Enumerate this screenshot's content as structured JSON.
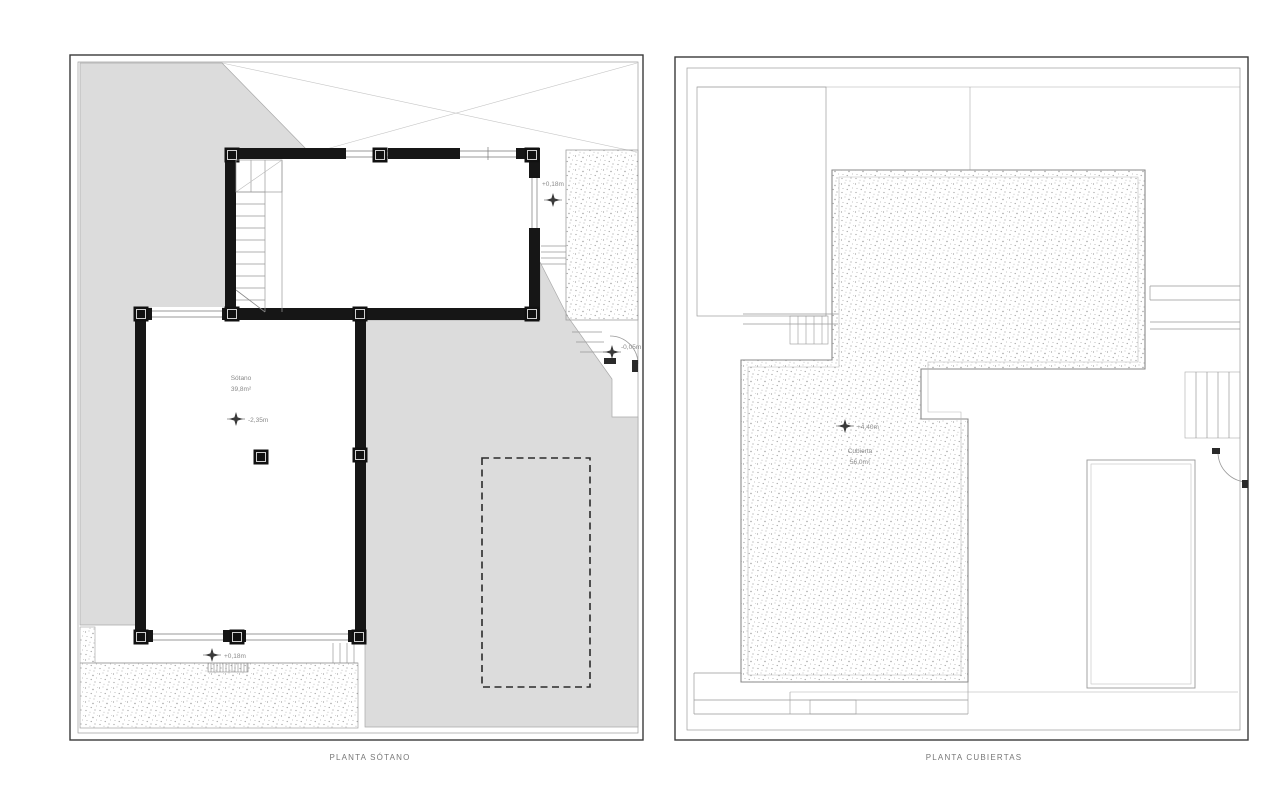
{
  "plans": {
    "basement": {
      "title": "PLANTA SÓTANO",
      "room": {
        "name": "Sótano",
        "area": "39,8m²"
      },
      "level_markers": {
        "upper_terrace": "+0,18m",
        "lower_terrace": "+0,18m",
        "floor": "-2,35m",
        "entry": "-0,05m"
      }
    },
    "roof": {
      "title": "PLANTA CUBIERTAS",
      "room": {
        "name": "Cubierta",
        "area": "56,0m²"
      },
      "level_markers": {
        "roof": "+4,40m"
      }
    }
  },
  "colors": {
    "wall": "#161616",
    "terrain_fill": "#dcdcdc",
    "thin_line": "#999999",
    "text": "#8a8a8a"
  }
}
